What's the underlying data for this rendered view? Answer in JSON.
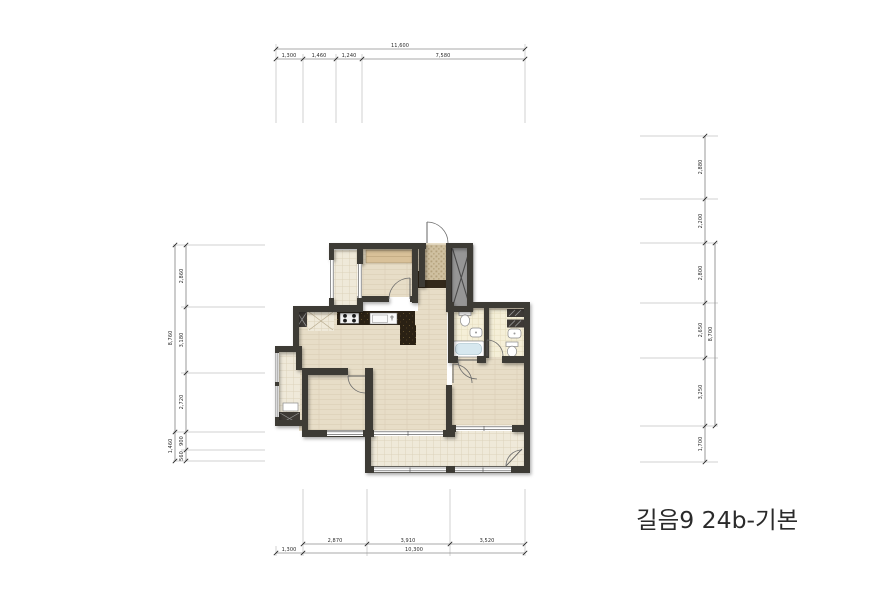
{
  "title": "길음9 24b-기본",
  "dimensions": {
    "top": {
      "total": "11,600",
      "segments": [
        "1,300",
        "1,460",
        "1,240",
        "7,580"
      ]
    },
    "bottom": {
      "total": "10,300",
      "offset": "1,300",
      "segments": [
        "2,870",
        "3,910",
        "3,520"
      ]
    },
    "left": {
      "total": "8,760",
      "segments": [
        "2,860",
        "3,180",
        "2,720"
      ],
      "sub_total": "1,460",
      "sub_segments": [
        "900",
        "560"
      ]
    },
    "right": {
      "group_total": "8,700",
      "segments": [
        "2,880",
        "2,200",
        "2,800",
        "2,650",
        "3,250",
        "1,700"
      ]
    }
  },
  "colors": {
    "wall": "#3e3a36",
    "wood_floor": "#e7ddc7",
    "balcony_tile": "#efe9d9",
    "bath_tile": "#f5efd8",
    "entry_tile": "#cfc0a0",
    "counter": "#2a2114",
    "closet": "#d9c199",
    "shaft": "#969696",
    "tub_water": "#d7e8ef",
    "dimension_line": "#555555",
    "text": "#1c1c1c"
  }
}
